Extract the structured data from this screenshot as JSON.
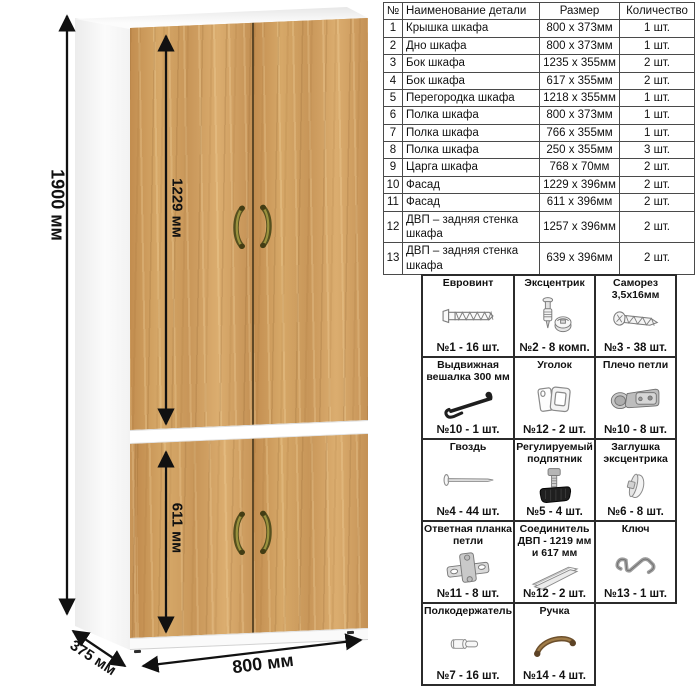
{
  "wardrobe": {
    "dimensions": {
      "height": "1900 мм",
      "upper_door_height": "1229 мм",
      "lower_door_height": "611 мм",
      "width": "800 мм",
      "depth": "375 мм"
    }
  },
  "parts_table": {
    "headers": {
      "num": "№",
      "name": "Наименование детали",
      "size": "Размер",
      "qty": "Количество"
    },
    "rows": [
      {
        "num": "1",
        "name": "Крышка шкафа",
        "size": "800 х 373мм",
        "qty": "1 шт."
      },
      {
        "num": "2",
        "name": "Дно шкафа",
        "size": "800 х 373мм",
        "qty": "1 шт."
      },
      {
        "num": "3",
        "name": "Бок шкафа",
        "size": "1235 х 355мм",
        "qty": "2 шт."
      },
      {
        "num": "4",
        "name": "Бок шкафа",
        "size": "617 х 355мм",
        "qty": "2 шт."
      },
      {
        "num": "5",
        "name": "Перегородка шкафа",
        "size": "1218 х 355мм",
        "qty": "1 шт."
      },
      {
        "num": "6",
        "name": "Полка шкафа",
        "size": "800 х 373мм",
        "qty": "1 шт."
      },
      {
        "num": "7",
        "name": "Полка шкафа",
        "size": "766 х 355мм",
        "qty": "1 шт."
      },
      {
        "num": "8",
        "name": "Полка шкафа",
        "size": "250 х 355мм",
        "qty": "3 шт."
      },
      {
        "num": "9",
        "name": "Царга шкафа",
        "size": "768 х 70мм",
        "qty": "2 шт."
      },
      {
        "num": "10",
        "name": "Фасад",
        "size": "1229 х 396мм",
        "qty": "2 шт."
      },
      {
        "num": "11",
        "name": "Фасад",
        "size": "611 х 396мм",
        "qty": "2 шт."
      },
      {
        "num": "12",
        "name": "ДВП – задняя стенка шкафа",
        "size": "1257 х 396мм",
        "qty": "2 шт."
      },
      {
        "num": "13",
        "name": "ДВП – задняя стенка шкафа",
        "size": "639 х 396мм",
        "qty": "2 шт."
      }
    ]
  },
  "hardware": {
    "columns": 3,
    "items": [
      {
        "label": "Евровинт",
        "qty": "№1 - 16 шт.",
        "icon": "euro-screw-icon"
      },
      {
        "label": "Эксцентрик",
        "qty": "№2 - 8 комп.",
        "icon": "eccentric-cam-icon"
      },
      {
        "label": "Саморез 3,5х16мм",
        "qty": "№3 - 38 шт.",
        "icon": "self-tapping-screw-icon"
      },
      {
        "label": "Выдвижная вешалка 300 мм",
        "qty": "№10 - 1 шт.",
        "icon": "pullout-hanger-icon"
      },
      {
        "label": "Уголок",
        "qty": "№12 - 2 шт.",
        "icon": "corner-bracket-icon"
      },
      {
        "label": "Плечо петли",
        "qty": "№10 - 8 шт.",
        "icon": "hinge-arm-icon"
      },
      {
        "label": "Гвоздь",
        "qty": "№4 - 44 шт.",
        "icon": "nail-icon"
      },
      {
        "label": "Регулируемый подпятник",
        "qty": "№5 - 4 шт.",
        "icon": "adjustable-foot-icon"
      },
      {
        "label": "Заглушка эксцентрика",
        "qty": "№6 - 8 шт.",
        "icon": "cam-cap-icon"
      },
      {
        "label": "Ответная планка петли",
        "qty": "№11 - 8 шт.",
        "icon": "hinge-plate-icon"
      },
      {
        "label": "Соединитель ДВП - 1219 мм и 617 мм",
        "qty": "№12 - 2 шт.",
        "icon": "hdf-connector-icon"
      },
      {
        "label": "Ключ",
        "qty": "№13 - 1 шт.",
        "icon": "hex-key-icon"
      },
      {
        "label": "Полкодержатель",
        "qty": "№7 - 16 шт.",
        "icon": "shelf-pin-icon"
      },
      {
        "label": "Ручка",
        "qty": "№14 - 4 шт.",
        "icon": "door-handle-icon"
      }
    ]
  },
  "colors": {
    "wood_base": "#cd9c5f",
    "door_seam": "#5f4826",
    "handle_bronze": "#8b8135",
    "line": "#111111",
    "table_border": "#4a4a4a",
    "grid_border": "#2b2b2b"
  }
}
